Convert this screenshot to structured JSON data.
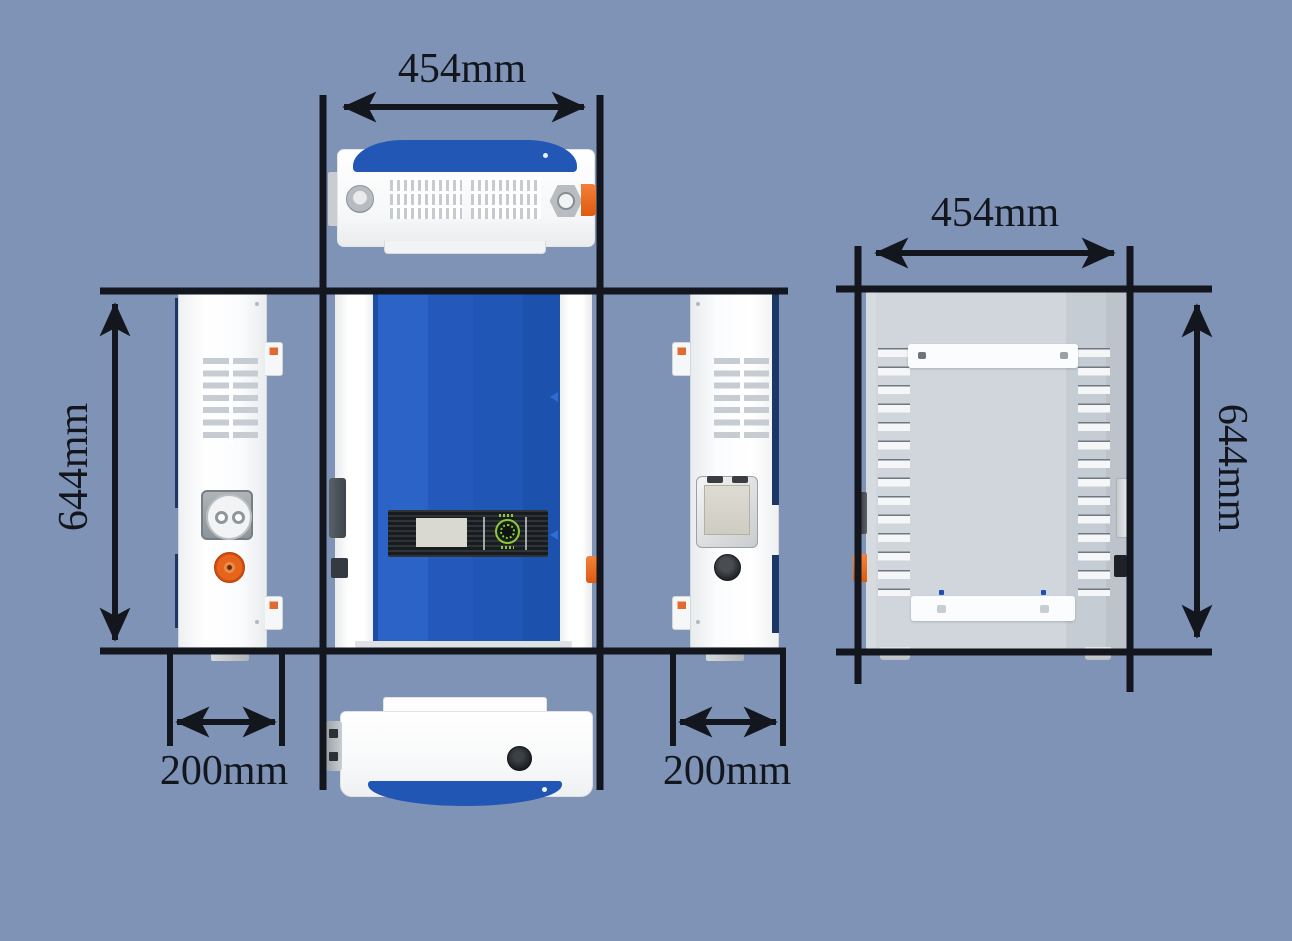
{
  "dimension_labels": {
    "top_width": "454mm",
    "back_width": "454mm",
    "front_height": "644mm",
    "back_height": "644mm",
    "left_depth": "200mm",
    "right_depth": "200mm"
  },
  "colors": {
    "background": "#7E93B6",
    "dimension_line": "#14161D",
    "device_blue": "#2057B8",
    "device_white": "#FCFDFE",
    "navy_trim": "#1A3766",
    "back_panel_gray": "#CED4DA",
    "accent_orange": "#E8641C",
    "logo_green": "#8DC63F",
    "display_black": "#191B1E",
    "screen_gray": "#D9D9D1"
  }
}
